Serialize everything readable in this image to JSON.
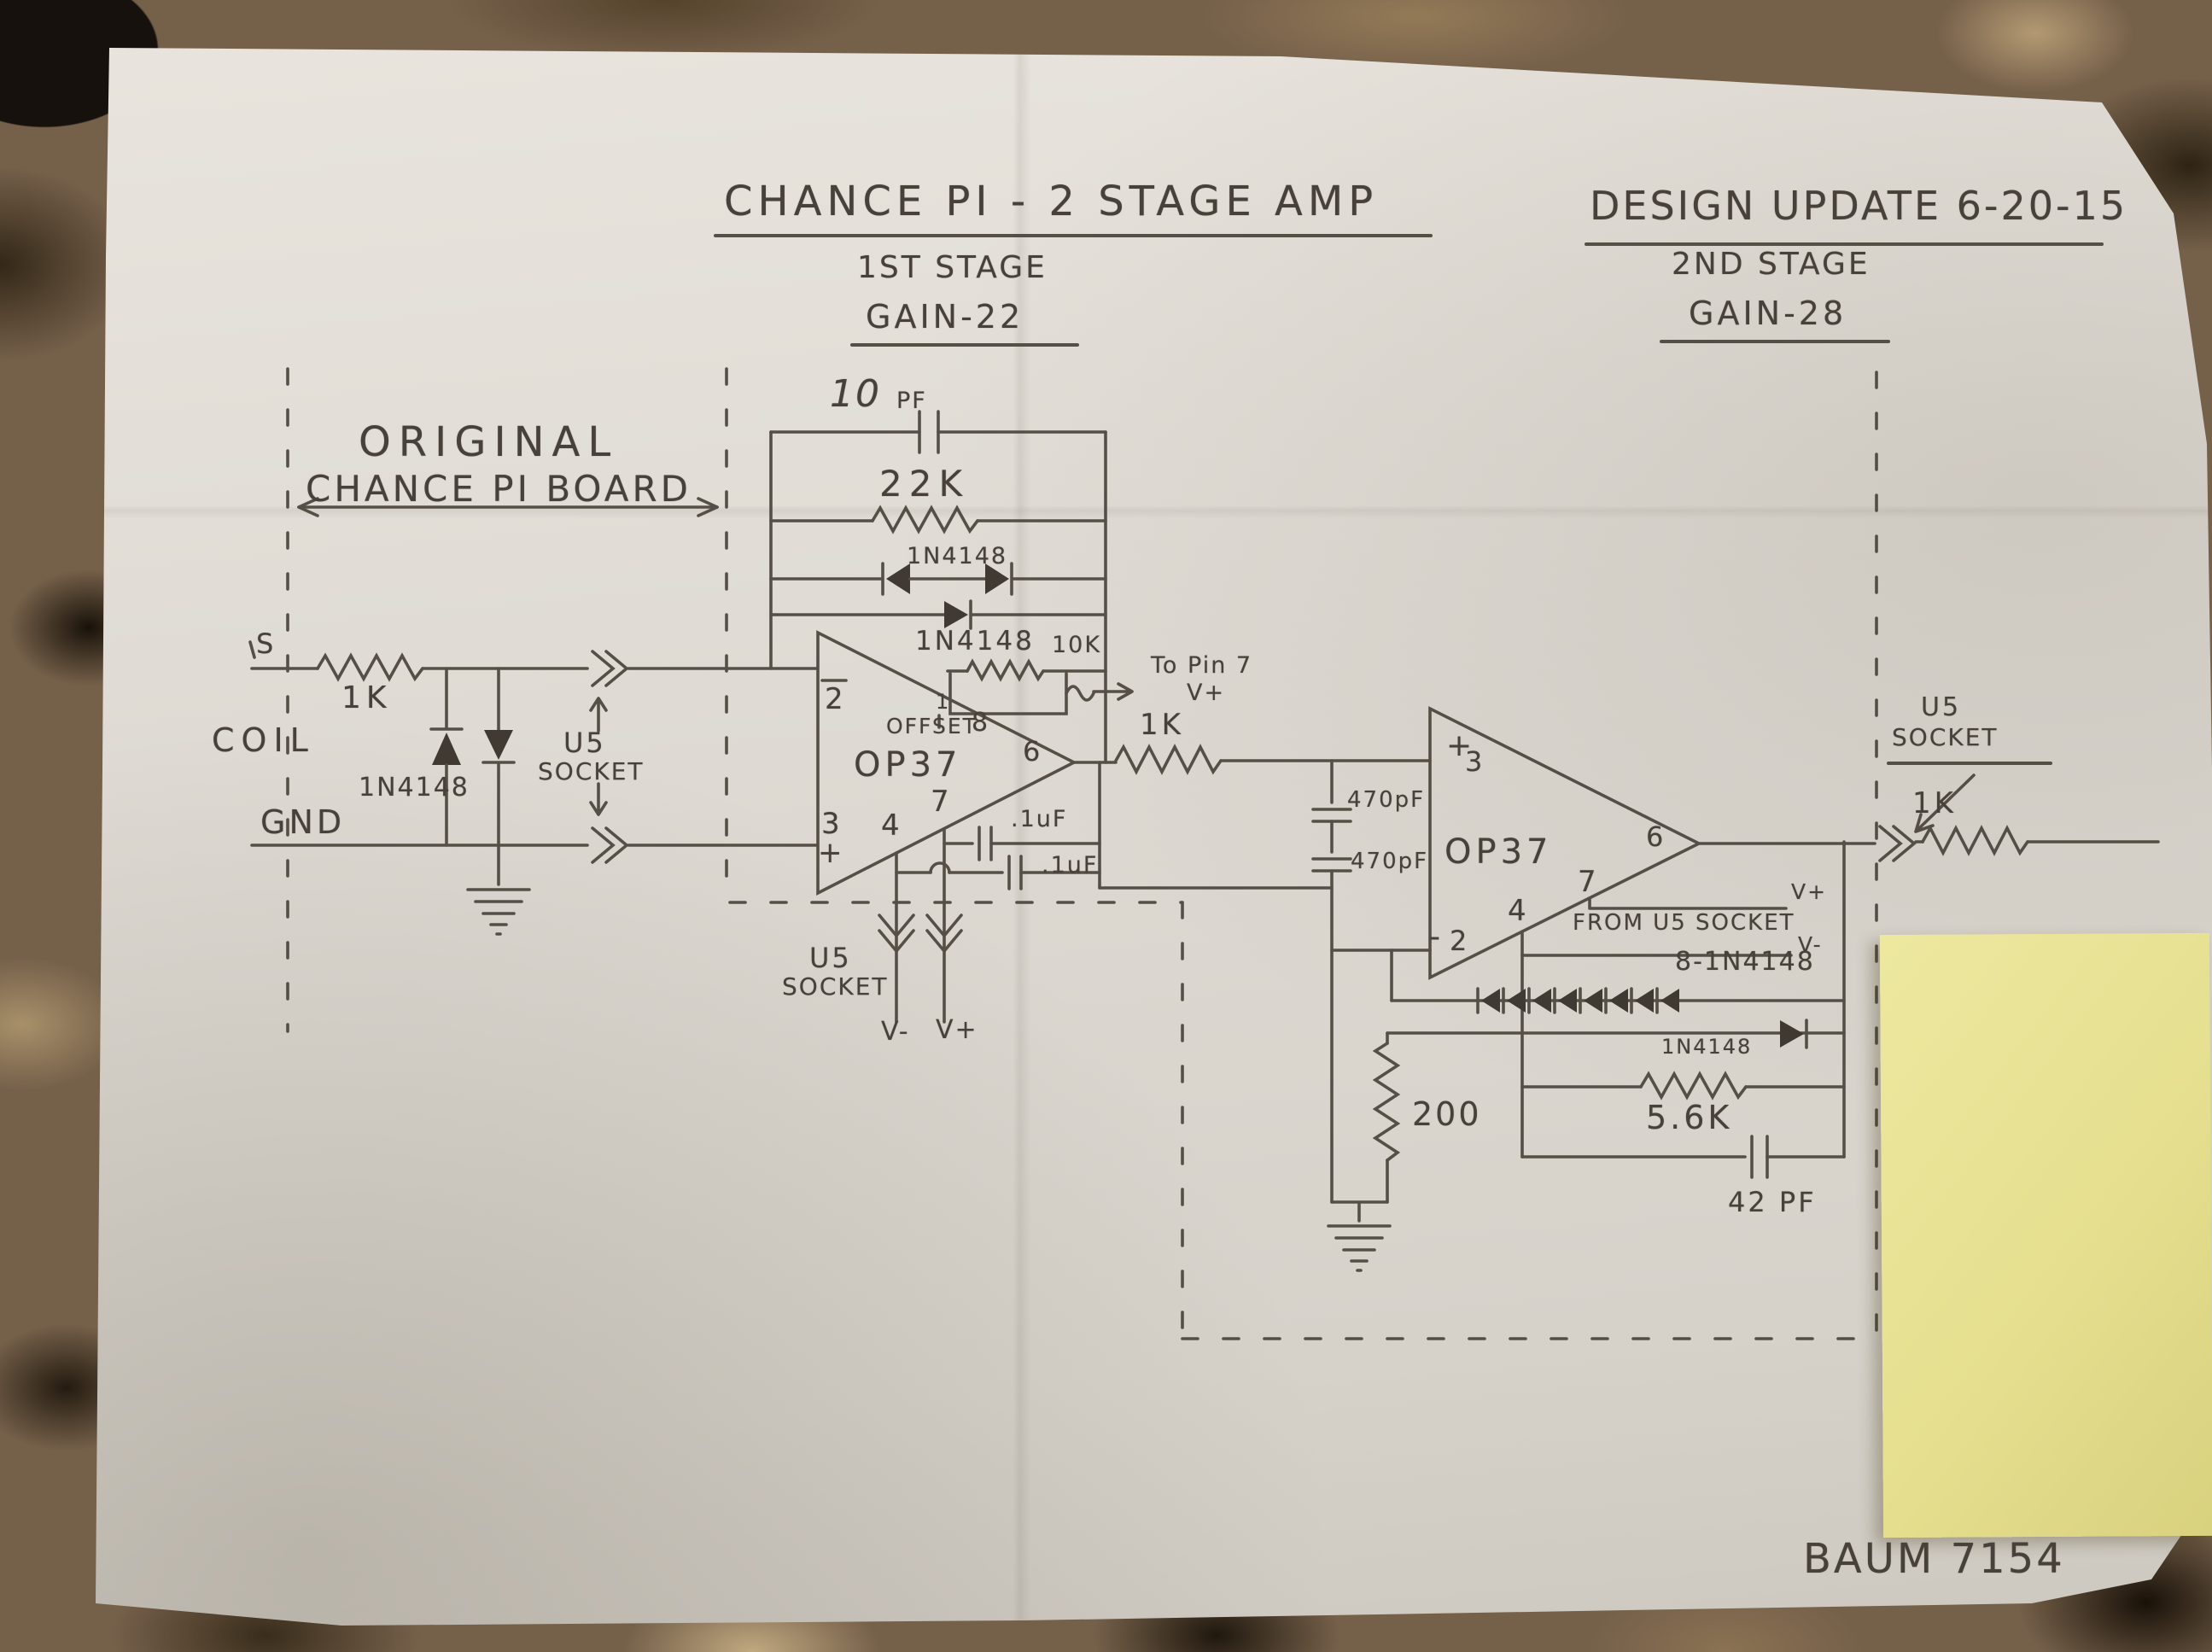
{
  "header": {
    "title": "CHANCE PI - 2 STAGE AMP",
    "design_update": "DESIGN UPDATE 6-20-15"
  },
  "stages": {
    "stage1_title": "1ST STAGE",
    "stage1_gain": "GAIN-22",
    "stage2_title": "2ND STAGE",
    "stage2_gain": "GAIN-28"
  },
  "board_note": {
    "line1": "ORIGINAL",
    "line2": "CHANCE PI BOARD"
  },
  "input": {
    "terminal_s": "S",
    "series_resistor": "1K",
    "coil": "COIL",
    "clamp_diodes": "1N4148",
    "gnd": "GND",
    "socket_word1": "U5",
    "socket_word2": "SOCKET"
  },
  "stage1": {
    "fb_cap_value": "10",
    "fb_cap_unit": "PF",
    "fb_resistor": "22K",
    "fb_diode_pair": "1N4148",
    "fb_diode": "1N4148",
    "trim_pot": "10K",
    "trim_note": "To Pin 7",
    "trim_rail": "V+",
    "offset_pin1": "1",
    "offset_label": "OFFSET",
    "offset_pin8": "8",
    "opamp": "OP37",
    "pin2": "2",
    "pin3": "3",
    "pin3_sign": "+",
    "pin4": "4",
    "pin7": "7",
    "pin6": "6",
    "bypass_cap1": ".1uF",
    "bypass_cap2": ".1uF",
    "socket_word1": "U5",
    "socket_word2": "SOCKET",
    "v_minus": "V-",
    "v_plus": "V+",
    "coupling_resistor": "1K"
  },
  "stage2": {
    "coupling_cap1": "470pF",
    "coupling_cap2": "470pF",
    "opamp": "OP37",
    "pin3_sign": "+",
    "pin3": "3",
    "pin2_sign": "-",
    "pin2": "2",
    "pin4": "4",
    "pin7": "7",
    "pin6": "6",
    "supply_note": "FROM U5 SOCKET",
    "v_plus": "V+",
    "v_minus": "V-",
    "diode_string": "8-1N4148",
    "fb_diode": "1N4148",
    "fb_resistor": "5.6K",
    "fb_cap": "42 PF",
    "shunt_resistor": "200",
    "socket_word1": "U5",
    "socket_word2": "SOCKET",
    "output_resistor": "1K"
  },
  "footer": {
    "signature": "BAUM 7154"
  },
  "colors": {
    "pencil": "#4a443b",
    "paper": "#ddd9d2",
    "sticky_note": "#e5df8f",
    "granite_dark": "#16110c",
    "granite_mid": "#75604a",
    "granite_light": "#b49a73"
  }
}
